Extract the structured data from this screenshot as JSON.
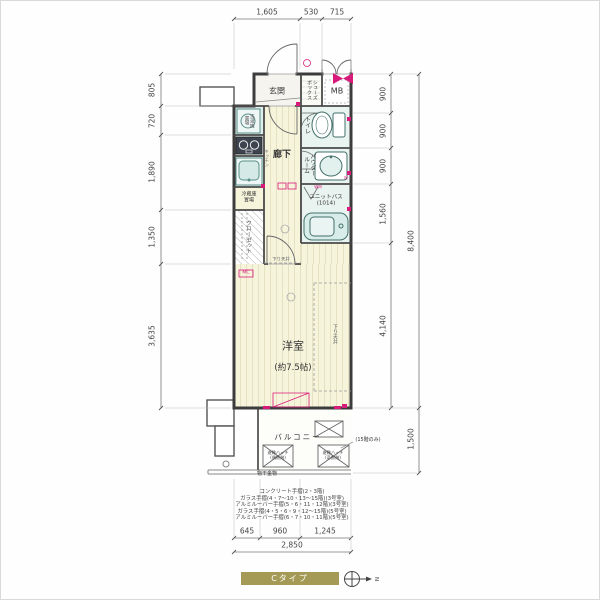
{
  "colors": {
    "accent": "#d81b7a",
    "floor": "#f7f4dc",
    "wet_area": "#e9f4f1",
    "fixture": "#d8ece9",
    "banner": "#a49a55",
    "wall": "#3c3c3c"
  },
  "dims": {
    "top": [
      "1,605",
      "530",
      "715"
    ],
    "left": [
      "805",
      "720",
      "1,890",
      "1,350",
      "3,635"
    ],
    "right_inner": [
      "900",
      "900",
      "900",
      "1,560",
      "4,140"
    ],
    "right_outer": [
      "8,400",
      "1,500"
    ],
    "bottom": [
      "645",
      "960",
      "1,245"
    ],
    "bottom_total": "2,850"
  },
  "rooms": {
    "genkan": "玄関",
    "shoe_box": "シューズ\nボックス",
    "mb": "MB",
    "laundry": "洗濯機\n置場",
    "kitchen": "キッチン",
    "fridge": "冷蔵庫\n置場",
    "hallway": "廊下",
    "toilet": "トイレ",
    "powder": "パウダー\nルーム",
    "unit_bath": "ユニットバス\n(1014)",
    "closet": "クローゼット",
    "western_room": "洋室",
    "western_room_size": "(約7.5帖)",
    "balcony": "バルコニー"
  },
  "notes": {
    "mc": "MC",
    "lowered_ceiling": "下り天井",
    "lowered_ceiling_2": "下り天井",
    "hatch_left": "避難ハッチ\n(偶数階)",
    "hatch_right": "避難ハッチ\n(奇数階)",
    "laundry_pole": "物干金物",
    "floor15_only": "(15階のみ)",
    "mark_m": "M",
    "mark_wm": "WM"
  },
  "railing_notes": [
    "コンクリート手摺(2・3階)",
    "ガラス手摺(4・7〜10・13〜15階)(3号室)",
    "アルミルーバー手摺(5・6・11・12階)(3号室)",
    "ガラス手摺(4・5・6・9・12〜15階)(5号室)",
    "アルミルーバー手摺(6・7・10・11階)(5号室)"
  ],
  "footer": {
    "type_label": "Cタイプ",
    "compass_letter": "N"
  }
}
